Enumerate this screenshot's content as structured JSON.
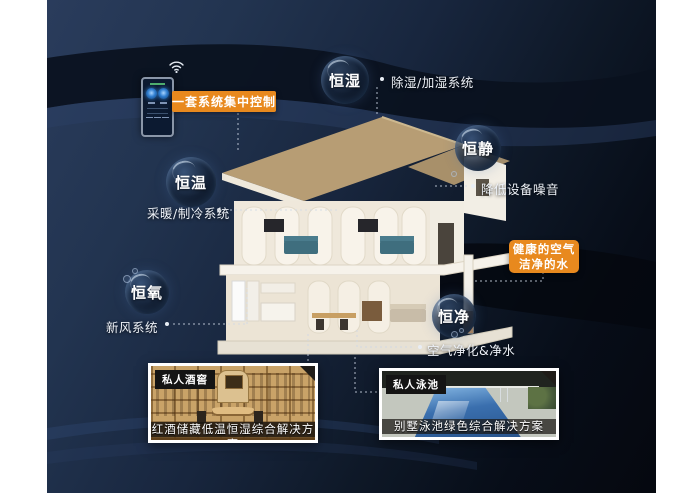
{
  "features": [
    {
      "name": "恒湿",
      "system": "除湿/加湿系统"
    },
    {
      "name": "恒静",
      "system": "降低设备噪音"
    },
    {
      "name": "恒温",
      "system": "采暖/制冷系统"
    },
    {
      "name": "恒氧",
      "system": "新风系统"
    },
    {
      "name": "恒净",
      "system": "空气净化&净水"
    }
  ],
  "controller": {
    "label": "一套系统集中控制"
  },
  "highlight": {
    "line1": "健康的空气",
    "line2": "洁净的水"
  },
  "gallery": [
    {
      "tag": "私人酒窖",
      "caption": "红酒储藏低温恒湿综合解决方案"
    },
    {
      "tag": "私人泳池",
      "caption": "别墅泳池绿色综合解决方案"
    }
  ],
  "colors": {
    "accent_orange": "#E8891E",
    "background_navy": "#1E2E4A",
    "bubble_text": "#FFFFFF",
    "note_text": "#EEF2F8"
  }
}
